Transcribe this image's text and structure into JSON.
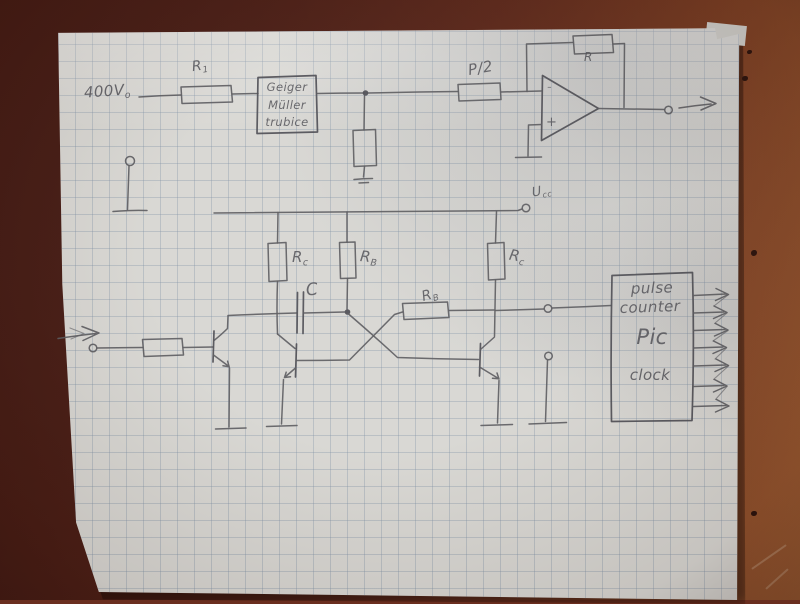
{
  "colors": {
    "table_dark": "#4a1d15",
    "table_light": "#9a5a31",
    "paper": "#d8d7d3",
    "grid_line": "#7d8ea4",
    "pencil": "#5b5b60"
  },
  "circuit": {
    "hv_label": {
      "main": "400V",
      "sub": "o"
    },
    "r1_label": {
      "main": "R",
      "sub": "1"
    },
    "geiger_box": {
      "line1": "Geiger",
      "line2": "Müller",
      "line3": "trubice"
    },
    "p2_label": "P/2",
    "feedback_r_label": "R",
    "opamp": {
      "minus": "-",
      "plus": "+"
    },
    "ucc_label": {
      "main": "U",
      "sub": "cc"
    },
    "rc_left_label": {
      "main": "R",
      "sub": "c"
    },
    "rb_left_label": {
      "main": "R",
      "sub": "B"
    },
    "cap_label": "C",
    "rb_right_label": {
      "main": "R",
      "sub": "B"
    },
    "rc_right_label": {
      "main": "R",
      "sub": "c"
    },
    "counter_box": {
      "line1": "pulse",
      "line2": "counter",
      "line3": "Pic",
      "line4": "clock"
    }
  }
}
